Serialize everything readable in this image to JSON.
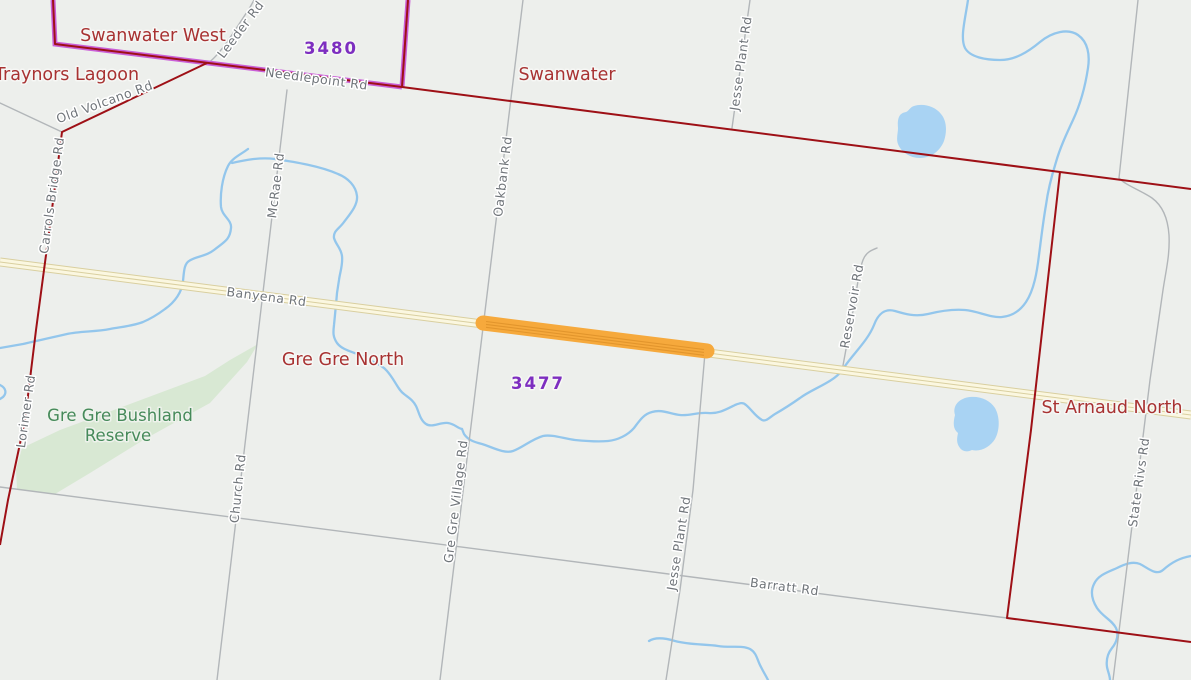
{
  "map": {
    "localities": [
      {
        "name": "Swanwater West"
      },
      {
        "name": "Traynors Lagoon"
      },
      {
        "name": "Swanwater"
      },
      {
        "name": "Gre Gre North"
      },
      {
        "name": "St Arnaud North"
      }
    ],
    "postcodes": [
      {
        "code": "3480"
      },
      {
        "code": "3477"
      }
    ],
    "reserve": {
      "line1": "Gre Gre Bushland",
      "line2": "Reserve"
    },
    "road_labels": [
      {
        "label": "Leeder Rd"
      },
      {
        "label": "Needlepoint Rd"
      },
      {
        "label": "Old Volcano Rd"
      },
      {
        "label": "Carrols Bridge Rd"
      },
      {
        "label": "McRae Rd"
      },
      {
        "label": "Oakbank Rd"
      },
      {
        "label": "Jesse Plant Rd"
      },
      {
        "label": "Banyena Rd"
      },
      {
        "label": "Reservoir Rd"
      },
      {
        "label": "Lorimer Rd"
      },
      {
        "label": "Church Rd"
      },
      {
        "label": "Gre Gre Village Rd"
      },
      {
        "label": "Jesse Plant Rd"
      },
      {
        "label": "Barratt Rd"
      },
      {
        "label": "State Rivs Rd"
      }
    ],
    "colors": {
      "background": "#edefec",
      "reserve_fill": "#d8e8d3",
      "stream": "#93c6ec",
      "pond": "#a9d3f3",
      "minor_road": "#b2b6b9",
      "major_road_fill": "#fbf7e0",
      "major_road_casing": "#d9cf9f",
      "highlight": "#f6a93c",
      "highlight_stripe": "#e2952c",
      "locality_boundary": "#9e1016",
      "postcode_boundary": "#ca5fd7",
      "locality_label": "#a83232",
      "postcode_label": "#7d2ec0",
      "road_label": "#70757a",
      "reserve_label": "#468a5a"
    }
  }
}
